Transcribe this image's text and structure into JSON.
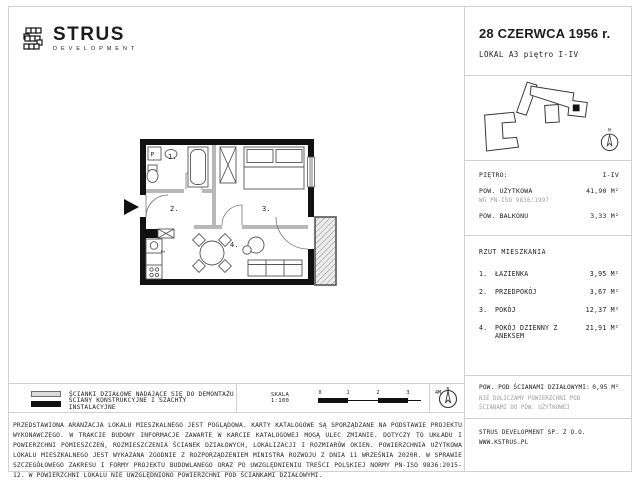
{
  "brand": {
    "name": "STRUS",
    "sub": "DEVELOPMENT"
  },
  "header": {
    "title": "28 CZERWCA 1956 r.",
    "subtitle": "LOKAL A3 piętro I-IV"
  },
  "info": {
    "rows": [
      {
        "label": "PIĘTRO:",
        "value": "I-IV"
      },
      {
        "label": "POW. UŻYTKOWA",
        "value": "41,90 M²",
        "note": "WG PN-ISO 9836:1997"
      },
      {
        "label": "POW. BALKONU",
        "value": "3,33 M²"
      }
    ]
  },
  "rooms": {
    "title": "RZUT MIESZKANIA",
    "items": [
      {
        "no": "1.",
        "name": "ŁAZIENKA",
        "area": "3,95 M²"
      },
      {
        "no": "2.",
        "name": "PRZEDPOKÓJ",
        "area": "3,67 M²"
      },
      {
        "no": "3.",
        "name": "POKÓJ",
        "area": "12,37 M²"
      },
      {
        "no": "4.",
        "name": "POKÓJ DZIENNY Z ANEKSEM",
        "area": "21,91 M²"
      }
    ]
  },
  "partitions": {
    "label": "POW. POD ŚCIANAMI DZIAŁOWYMI:",
    "value": "0,95 M²",
    "note": "NIE DOLICZAMY POWIERZCHNI POD ŚCIANAMI DO POW. UŻYTKOWEJ"
  },
  "footer": {
    "company": "STRUS DEVELOPMENT SP. Z O.O.",
    "website": "WWW.KSTRUS.PL"
  },
  "legend": {
    "items": [
      {
        "label": "ŚCIANKI DZIAŁOWE NADAJĄCE SIĘ DO DEMONTAŻU"
      },
      {
        "label": "ŚCIANY KONSTRUKCYJNE I SZACHTY INSTALACYJNE"
      }
    ]
  },
  "scale": {
    "label": "SKALA 1:100",
    "ticks": [
      "0",
      "1",
      "2",
      "3",
      "4M"
    ]
  },
  "compass": {
    "label": "N"
  },
  "plan": {
    "room_labels": [
      "1.",
      "2.",
      "3.",
      "4."
    ],
    "washer_label": "P",
    "kitchen_label": "Z"
  },
  "disclaimer": "PRZEDSTAWIONA ARANŻACJA LOKALU MIESZKALNEGO JEST POGLĄDOWA. KARTY KATALOGOWE SĄ SPORZĄDZANE NA PODSTAWIE PROJEKTU WYKONAWCZEGO. W TRAKCIE BUDOWY INFORMACJE ZAWARTE W KARCIE KATALOGOWEJ MOGĄ ULEC ZMIANIE. DOTYCZY TO UKŁADU I POWIERZCHNI POMIESZCZEŃ, ROZMIESZCZENIA ŚCIANEK DZIAŁOWYCH, LOKALIZACJI I ROZMIARÓW OKIEN. POWIERZCHNIA UŻYTKOWA LOKALU MIESZKALNEGO JEST WYKAZANA ZGODNIE Z ROZPORZĄDZENIEM MINISTRA ROZWOJU Z DNIA 11 WRZEŚNIA 2020R. W SPRAWIE SZCZEGÓŁOWEGO ZAKRESU I FORMY PROJEKTU BUDOWLANEGO ORAZ PO UWZGLĘDNIENIU TREŚCI POLSKIEJ NORMY PN-ISO 9836:2015-12. W POWIERZCHNI LOKALU NIE UWZGLĘDNIONO POWIERZCHNI POD ŚCIANKAMI DZIAŁOWYMI.",
  "colors": {
    "wall": "#111111",
    "partition": "#b8b8b8",
    "furniture_line": "#555555",
    "divider": "#cfd2d4",
    "note_gray": "#9d9d9d"
  }
}
